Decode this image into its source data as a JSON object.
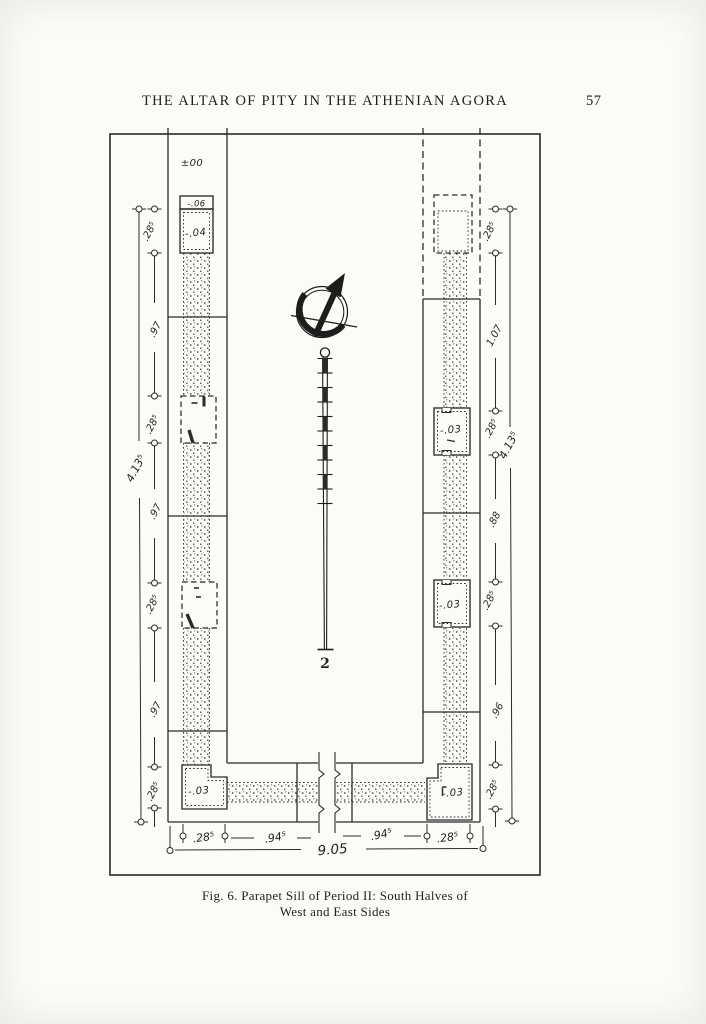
{
  "page": {
    "header_title": "THE ALTAR OF PITY IN THE ATHENIAN AGORA",
    "page_number": "57",
    "caption_line1": "Fig. 6.  Parapet Sill of Period II: South Halves of",
    "caption_line2": "West and East Sides"
  },
  "figure": {
    "datum_label": "±00",
    "west": {
      "cap_elevation": "-.06",
      "block_elevation": "-.04",
      "corner_elevation": "-.03",
      "dims": [
        ".28⁵",
        ".97",
        ".28⁵",
        ".97",
        ".28⁵",
        ".97",
        ".28⁵"
      ],
      "overall": "4.13⁵"
    },
    "east": {
      "mid_block_elevation": "-.03",
      "lower_block_elevation": "-.03",
      "corner_elevation": "-.03",
      "dims": [
        ".28⁵",
        "1.07",
        ".28⁵",
        ".88",
        ".28⁵",
        ".96",
        ".28⁵"
      ],
      "overall": "4.13⁵"
    },
    "south": {
      "dims": [
        ".28⁵",
        ".94⁵",
        ".94⁵",
        ".28⁵"
      ],
      "overall": "9.05"
    },
    "scale_rod": {
      "length_label": "2"
    },
    "icons": {
      "north_arrow": "north-arrow",
      "scale_rod": "leveling-rod"
    }
  }
}
